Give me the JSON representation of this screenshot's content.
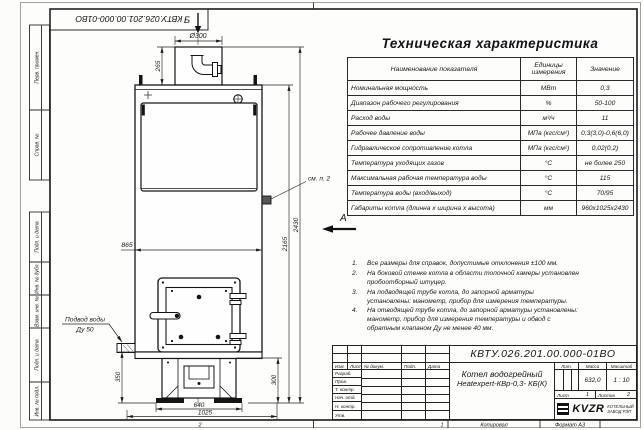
{
  "sheet": {
    "doc_number": "КВТУ.026.201.00.000-01ВО",
    "margin_labels": [
      "Перв. примен.",
      "Справ. №",
      "Подп. и дата",
      "Инв. № дубл.",
      "Взам. инв. №",
      "Подп. и дата",
      "Инв. № подл."
    ],
    "bottom_strip": {
      "zone2": "2",
      "zone1": "1",
      "copied_label": "Копировал",
      "format_label": "Формат А3"
    }
  },
  "drawing": {
    "view_b_label": "Б",
    "view_a_label": "А",
    "note_callout": "см. п. 2",
    "water_inlet": {
      "line1": "Подвод воды",
      "line2": "Ду 50"
    },
    "dims": {
      "flue_diameter": "Ø300",
      "flue_height": "265",
      "body_width": "865",
      "body_height": "2165",
      "total_height": "2430",
      "base_height": "350",
      "base_height_right": "300",
      "feet_width": "640",
      "base_width": "1025"
    }
  },
  "spec": {
    "title": "Техническая характеристика",
    "col_name": "Наименование показателя",
    "col_units": "Единицы измерения",
    "col_value": "Значение",
    "rows": [
      {
        "name": "Номинальная мощность",
        "unit": "МВт",
        "value": "0,3"
      },
      {
        "name": "Диапазон рабочего регулирования",
        "unit": "%",
        "value": "50-100"
      },
      {
        "name": "Расход воды",
        "unit": "м³/ч",
        "value": "11"
      },
      {
        "name": "Рабочее давление воды",
        "unit": "МПа (кгс/см²)",
        "value": "0,3(3,0)-0,6(6,0)"
      },
      {
        "name": "Гидравлическое сопротивление котла",
        "unit": "МПа (кгс/см²)",
        "value": "0,02(0,2)"
      },
      {
        "name": "Температура уходящих газов",
        "unit": "°С",
        "value": "не более 250"
      },
      {
        "name": "Максимальная рабочая температура воды",
        "unit": "°С",
        "value": "115"
      },
      {
        "name": "Температура воды (вход/выход)",
        "unit": "°С",
        "value": "70/95"
      },
      {
        "name": "Габариты котла (длинна х ширина х высота)",
        "unit": "мм",
        "value": "960х1025х2430"
      }
    ]
  },
  "notes": {
    "items": [
      {
        "num": "1.",
        "text": "Все размеры для справок, допустимые отклонения ±100 мм."
      },
      {
        "num": "2.",
        "text": "На боковой стенке котла в области топочной камеры установлен пробоотборный штуцер."
      },
      {
        "num": "3.",
        "text": "На подводящей трубе котла, до запорной арматуры установлены: манометр, прибор для измерения температуры."
      },
      {
        "num": "4.",
        "text": "На отводящей трубе котла, до запорной арматуры установлены: манометр, прибор для измерения температуры и обвод с обратным клапаном Ду не менее 40 мм."
      }
    ]
  },
  "title_block": {
    "doc_number": "КВТУ.026.201.00.000-01ВО",
    "product_line1": "Котел водогрейный",
    "product_line2": "Heatexpert-КВр-0,3- КБ(К)",
    "rev_headers": {
      "izm": "Изм.",
      "list": "Лист",
      "doc": "№ докум.",
      "sign": "Подп.",
      "date": "Дата"
    },
    "role_rows": [
      "Разраб.",
      "Пров.",
      "Т. контр.",
      "Нач. отд.",
      "Н. контр.",
      "Утв."
    ],
    "lit_label": "Лит.",
    "mass_label": "Масса",
    "scale_label": "Масштаб",
    "mass_value": "632,0",
    "scale_value": "1 : 10",
    "sheet_label": "Лист",
    "sheet_value": "1",
    "sheets_label": "Листов",
    "sheets_value": "2",
    "company": {
      "logo_text": "KVZR",
      "name_line1": "КОТЕЛЬНЫЙ",
      "name_line2": "ЗАВОД РЭП"
    }
  }
}
